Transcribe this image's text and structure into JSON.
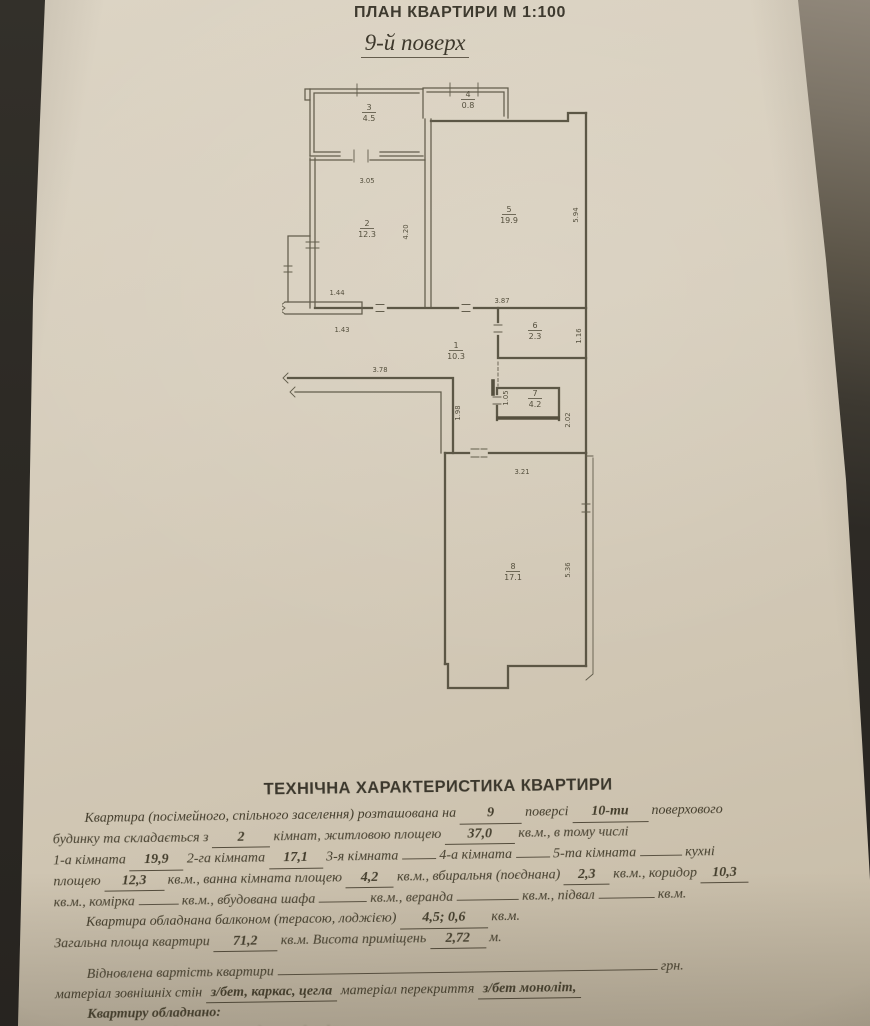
{
  "photo": {
    "surface_color": "#2d2a25",
    "surface_highlight_color": "#90877a",
    "paper_color": "#d7cebd",
    "ink_color": "#45402f"
  },
  "header": {
    "plan_title": "ПЛАН КВАРТИРИ М 1:100",
    "floor_label": "9-й поверх"
  },
  "plan": {
    "rooms": [
      {
        "n": "1",
        "area": "10.3",
        "x": 174,
        "y": 272
      },
      {
        "n": "2",
        "area": "12.3",
        "x": 85,
        "y": 150
      },
      {
        "n": "3",
        "area": "4.5",
        "x": 87,
        "y": 34
      },
      {
        "n": "4",
        "area": "0.8",
        "x": 186,
        "y": 21
      },
      {
        "n": "5",
        "area": "19.9",
        "x": 227,
        "y": 136
      },
      {
        "n": "6",
        "area": "2.3",
        "x": 253,
        "y": 252
      },
      {
        "n": "7",
        "area": "4.2",
        "x": 253,
        "y": 320
      },
      {
        "n": "8",
        "area": "17.1",
        "x": 231,
        "y": 493
      }
    ],
    "dims": [
      {
        "t": "3.05",
        "x": 85,
        "y": 107,
        "r": 0
      },
      {
        "t": "4.20",
        "x": 126,
        "y": 156,
        "r": -90
      },
      {
        "t": "5.94",
        "x": 296,
        "y": 139,
        "r": -90
      },
      {
        "t": "3.87",
        "x": 220,
        "y": 227,
        "r": 0
      },
      {
        "t": "1.44",
        "x": 55,
        "y": 219,
        "r": 0
      },
      {
        "t": "1.43",
        "x": 60,
        "y": 256,
        "r": 0
      },
      {
        "t": "3.78",
        "x": 98,
        "y": 296,
        "r": 0
      },
      {
        "t": "1.98",
        "x": 178,
        "y": 337,
        "r": -90
      },
      {
        "t": "1.16",
        "x": 299,
        "y": 260,
        "r": -90
      },
      {
        "t": "1.05",
        "x": 226,
        "y": 322,
        "r": -90
      },
      {
        "t": "2.02",
        "x": 288,
        "y": 344,
        "r": -90
      },
      {
        "t": "3.21",
        "x": 240,
        "y": 398,
        "r": 0
      },
      {
        "t": "5.36",
        "x": 288,
        "y": 494,
        "r": -90
      }
    ]
  },
  "tech": {
    "title": "ТЕХНІЧНА ХАРАКТЕРИСТИКА КВАРТИРИ",
    "lines": [
      {
        "indent": true,
        "segs": [
          {
            "t": "Квартира (посімейного, спільного заселення) розташована на "
          },
          {
            "v": "9",
            "w": 52
          },
          {
            "t": " поверсі "
          },
          {
            "v": "10-ти",
            "w": 66
          },
          {
            "t": " поверхового"
          }
        ]
      },
      {
        "segs": [
          {
            "t": "будинку та складається з "
          },
          {
            "v": "2",
            "w": 48
          },
          {
            "t": " кімнат, житловою площею "
          },
          {
            "v": "37,0",
            "w": 60
          },
          {
            "t": " кв.м., в тому числі"
          }
        ]
      },
      {
        "segs": [
          {
            "t": "1-а кімната "
          },
          {
            "v": "19,9",
            "w": 44
          },
          {
            "t": " 2-га кімната "
          },
          {
            "v": "17,1",
            "w": 44
          },
          {
            "t": " 3-я кімната "
          },
          {
            "u": 34
          },
          {
            "t": " 4-а кімната "
          },
          {
            "u": 34
          },
          {
            "t": " 5-та кімната "
          },
          {
            "u": 42
          },
          {
            "t": " кухні"
          }
        ]
      },
      {
        "segs": [
          {
            "t": "площею "
          },
          {
            "v": "12,3",
            "w": 50
          },
          {
            "t": " кв.м., ванна кімната площею "
          },
          {
            "v": "4,2",
            "w": 38
          },
          {
            "t": " кв.м., вбиральня (поєднана) "
          },
          {
            "v": "2,3",
            "w": 36
          },
          {
            "t": " кв.м., коридор "
          },
          {
            "v": "10,3",
            "w": 38
          }
        ]
      },
      {
        "segs": [
          {
            "t": "кв.м., комірка "
          },
          {
            "u": 40
          },
          {
            "t": " кв.м., вбудована шафа "
          },
          {
            "u": 48
          },
          {
            "t": " кв.м., веранда "
          },
          {
            "u": 62
          },
          {
            "t": " кв.м., підвал "
          },
          {
            "u": 56
          },
          {
            "t": " кв.м."
          }
        ]
      },
      {
        "indent": true,
        "segs": [
          {
            "t": "Квартира обладнана балконом (терасою, лоджією) "
          },
          {
            "v": "4,5; 0,6",
            "w": 78
          },
          {
            "t": " кв.м."
          }
        ]
      },
      {
        "segs": [
          {
            "t": "Загальна площа квартири "
          },
          {
            "v": "71,2",
            "w": 54
          },
          {
            "t": " кв.м. Висота приміщень "
          },
          {
            "v": "2,72",
            "w": 46
          },
          {
            "t": " м."
          }
        ]
      },
      {
        "indent": true,
        "gap": true,
        "segs": [
          {
            "t": "Відновлена вартість квартири "
          },
          {
            "u": 380
          },
          {
            "t": " грн."
          }
        ]
      },
      {
        "segs": [
          {
            "t": "матеріал зовнішніх стін "
          },
          {
            "v": "з/бет, каркас, цегла",
            "w": 0
          },
          {
            "t": " матеріал перекриття "
          },
          {
            "v": "з/бет моноліт,",
            "w": 0
          }
        ]
      },
      {
        "indent": true,
        "bold": true,
        "segs": [
          {
            "t": "Квартиру обладнано:"
          }
        ]
      },
      {
        "blur": true,
        "segs": [
          {
            "t": "водопроводом (холодним, гарячим), каналізацією,"
          }
        ]
      }
    ]
  }
}
